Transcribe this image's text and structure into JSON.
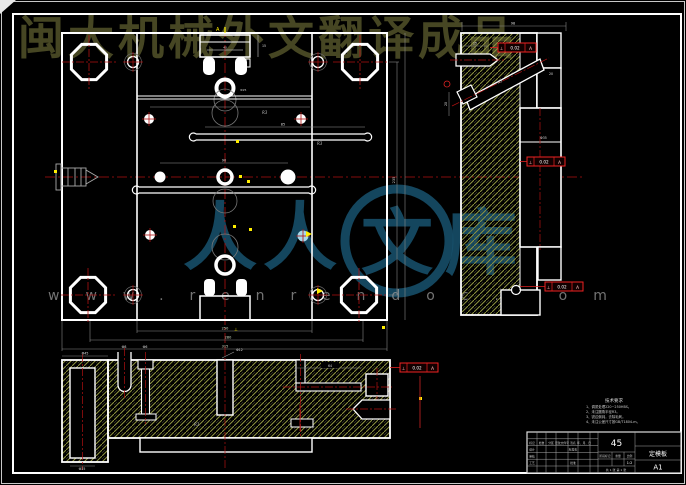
{
  "page": {
    "bg": "#000000",
    "frame_color": "#ffffff"
  },
  "watermarks": {
    "top_text": "闽大机械外文翻译成品",
    "brand_left": "人人",
    "brand_circle": "文",
    "brand_right": "库",
    "site_url": "www.renrendoc.com",
    "top_color": "#4d4d26",
    "brand_color": "#17506b",
    "url_color": "#9a9a9a"
  },
  "gdt": {
    "symbol": "⊥",
    "tolerance": "0.02",
    "datum": "A"
  },
  "labels": {
    "section_a": "A",
    "perp": "⊥",
    "d40": "40",
    "d15": "15",
    "sprue": "Ф25",
    "d85": "85",
    "d90": "90",
    "d98": "98",
    "d25": "25",
    "d20": "20",
    "d235": "235",
    "d250": "250",
    "d280": "280",
    "d315": "315",
    "f35": "Ф35",
    "f45": "Ф45",
    "f8": "Ф8",
    "f6": "Ф6",
    "f12": "Ф12",
    "d64": "64",
    "f25": "Ф25",
    "r3a": "R3",
    "r3b": "R3",
    "r3c": "R3"
  },
  "notes": {
    "title": "技术要求",
    "lines": [
      "1、调质处理220~250HBS。",
      "2、未注圆角半径R3。",
      "3、锐边倒钝，去除毛刺。",
      "4、未注公差尺寸按GB/T1804-m。"
    ]
  },
  "title_block": {
    "material": "45",
    "part_name": "定模板",
    "drawing_no": "A1",
    "header_cells": [
      "标记",
      "处数",
      "分区",
      "更改文件号",
      "签名",
      "年、月、日"
    ],
    "row_labels": [
      "设计",
      "审核",
      "工艺",
      "批准"
    ],
    "std_label": "标准化",
    "stage_label": "阶段标记",
    "weight_label": "重量",
    "scale_label": "比例",
    "scale_value": "1:2",
    "sheet_info": "共 1 张  第 1 张"
  }
}
